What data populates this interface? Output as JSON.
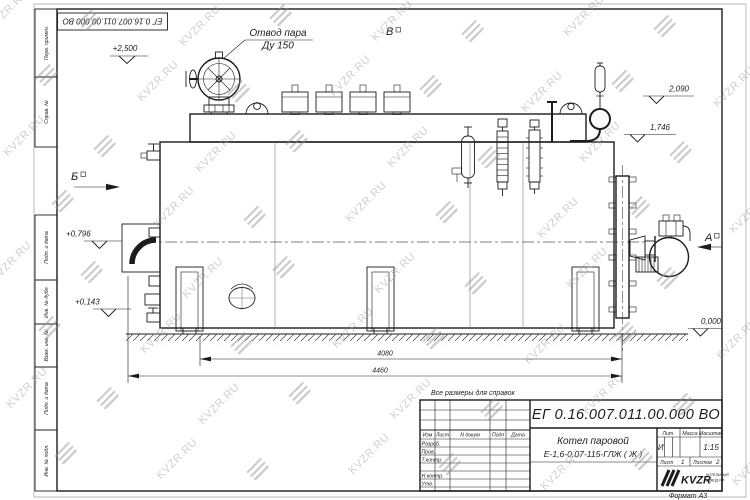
{
  "watermark": {
    "text": "KVZR.RU"
  },
  "frame": {
    "top_stamp": "ЕГ 0.16.007.011.00.000  ВО",
    "margin_columns": [
      "Перв. примен.",
      "Справ. №",
      "Подп. и дата",
      "Инв. № дубл.",
      "Взам. инв. №",
      "Подп. и дата",
      "Инв. № подл."
    ],
    "format_label": "Формат А3"
  },
  "drawing": {
    "note_steam_line1": "Отвод пара",
    "note_steam_line2": "Ду 150",
    "view_b": "Б",
    "view_v": "В",
    "view_a": "А",
    "elev_plus2500": "+2,500",
    "elev_2090": "2,090",
    "elev_1746": "1,746",
    "elev_plus0796": "+0,796",
    "elev_plus0143": "+0,143",
    "elev_0000": "0,000",
    "dim_4080": "4080",
    "dim_4460": "4460"
  },
  "title_block": {
    "reference_note": "Все размеры для справок",
    "doc_number": "ЕГ 0.16.007.011.00.000  ВО",
    "product_name": "Котел паровой",
    "product_model": "Е-1,6-0,07-115-ГЛЖ ( Ж )",
    "col_izm": "Изм",
    "col_list": "Лист",
    "col_ndoc": "N докум",
    "col_podp": "Подп",
    "col_data": "Дата",
    "row_razrab": "Разраб.",
    "row_prov": "Пров.",
    "row_tkontr": "Т.контр.",
    "row_nkontr": "Н.контр.",
    "row_utv": "Утв.",
    "lit_label": "Лит.",
    "mass_label": "Масса",
    "scale_label": "Масштаб",
    "lit_value": "И",
    "scale_value": "1:15",
    "sheet_label": "Лист",
    "sheet_value": "1",
    "sheets_label": "Листов",
    "sheets_value": "2",
    "logo_text": "KVZR",
    "logo_caption_line1": "КОТЕЛЬНЫЙ",
    "logo_caption_line2": "ЗАВОД РФ"
  }
}
